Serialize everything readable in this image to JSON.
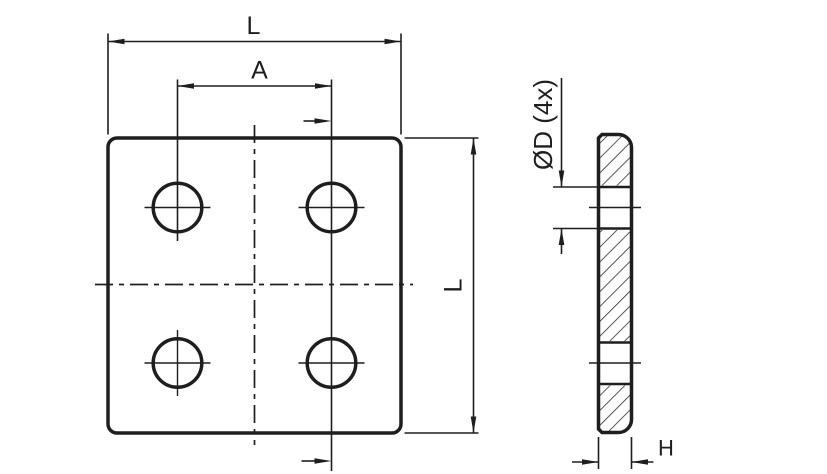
{
  "drawing": {
    "background_color": "#ffffff",
    "line_color": "#1e1e1e",
    "front_view": {
      "dim_width_label": "L",
      "dim_hole_spacing_label": "A",
      "dim_height_label": "L"
    },
    "section_view": {
      "dim_hole_diameter_label": "ØD (4x)",
      "dim_thickness_label": "H"
    }
  }
}
